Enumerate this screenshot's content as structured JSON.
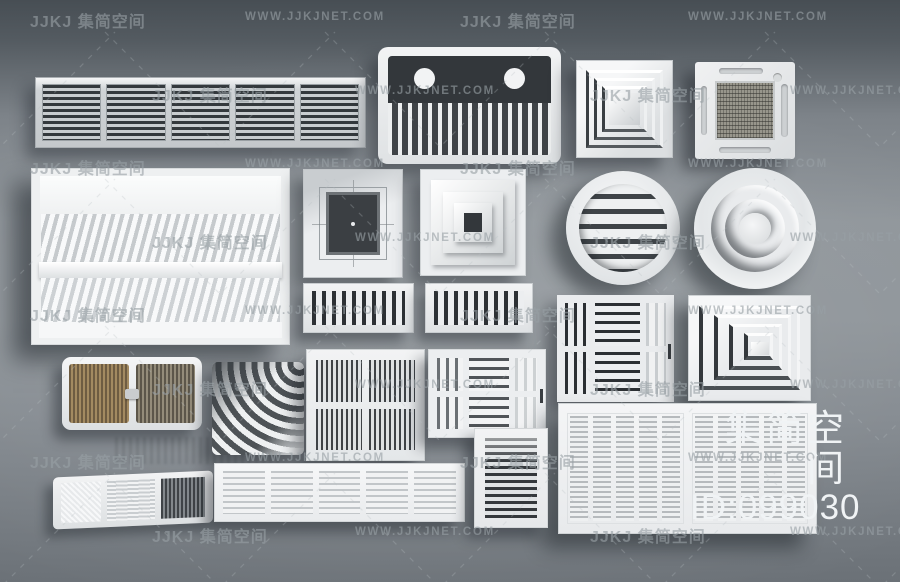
{
  "page": {
    "type": "3d-product-render",
    "subject": "HVAC air vent and ventilation grille 3D model collection"
  },
  "watermark": {
    "logo_text": "JJKJ 集简空间",
    "site_text": "WWW.JJKJNET.COM"
  },
  "overlay": {
    "brand": "集简空间",
    "id_label": "ID:099030"
  },
  "colors": {
    "bg_top": "#474e54",
    "bg_mid": "#90969b",
    "bg_bottom": "#6b7177",
    "vent_body": "#eceef0",
    "slat_dark": "#33373b",
    "mesh_tan": "#98968c",
    "wood_brown": "#a38a61",
    "watermark_gray": "rgba(152,159,165,0.62)",
    "overlay_text": "#f0f3f5"
  },
  "items": [
    "linear-return-grille-wide",
    "exhaust-vent-dual-round-comb",
    "square-step-diffuser-small",
    "ceiling-cassette-ac-unit",
    "open-box-louver-vent-large",
    "square-diffuser-concentric-thin",
    "square-diffuser-pyramid",
    "round-louver-vent",
    "round-cone-diffuser",
    "slot-grille-left",
    "slot-grille-right",
    "multi-section-register-dark",
    "corner-step-diffuser",
    "wood-slat-vent-rounded",
    "curved-fin-vent",
    "quad-panel-slat-vent",
    "multi-section-register-light",
    "double-panel-grille-large",
    "wedge-floor-vent",
    "linear-slat-grille-long",
    "vertical-slat-grille-small"
  ]
}
